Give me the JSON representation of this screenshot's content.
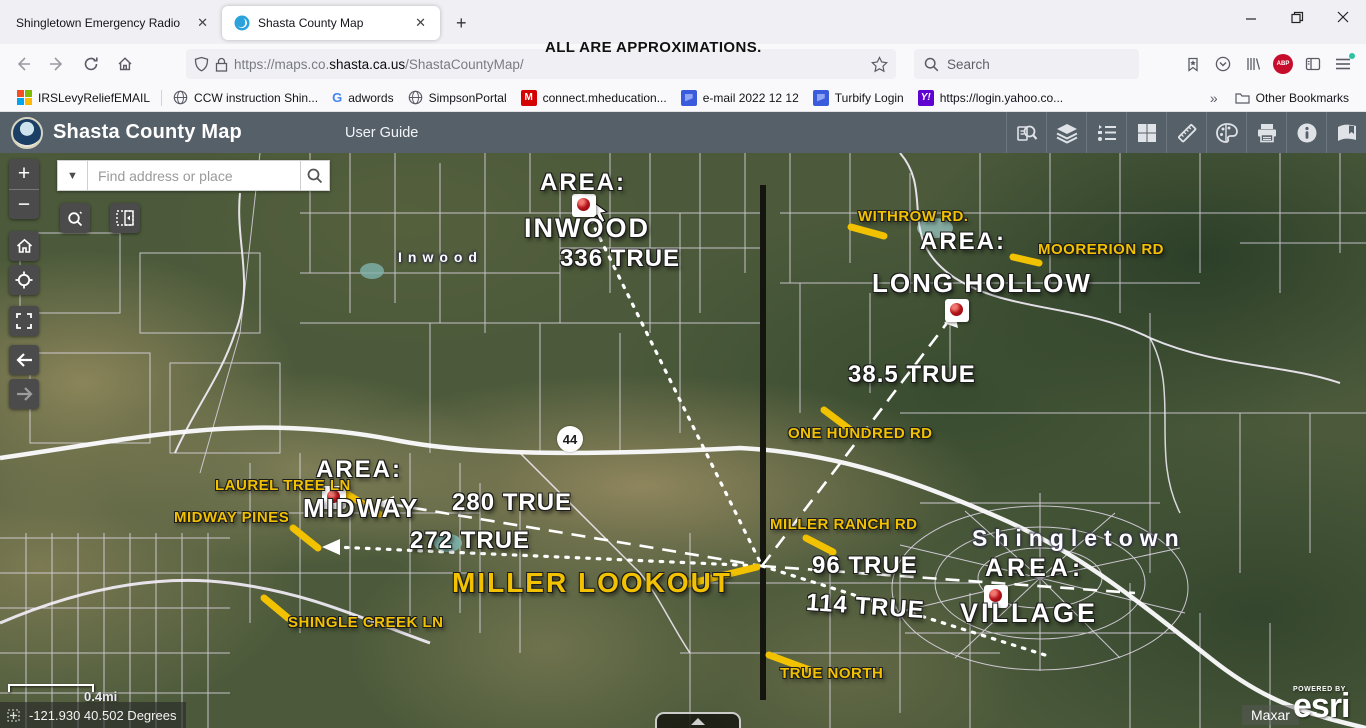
{
  "browser": {
    "tabs": [
      {
        "label": "Shingletown Emergency Radio"
      },
      {
        "label": "Shasta County Map"
      }
    ],
    "close_tab_glyph": "✕",
    "new_tab_glyph": "+",
    "url_prefix": "https://maps.co.",
    "url_domain": "shasta.ca.us",
    "url_path": "/ShastaCountyMap/",
    "search_placeholder": "Search",
    "bookmarks": [
      "IRSLevyReliefEMAIL",
      "CCW instruction Shin...",
      "adwords",
      "SimpsonPortal",
      "connect.mheducation...",
      "e-mail 2022 12 12",
      "Turbify Login",
      "https://login.yahoo.co..."
    ],
    "bookmarks_overflow_glyph": "»",
    "other_bookmarks_label": "Other Bookmarks",
    "adblock_badge": "ABP"
  },
  "overlay_note": "ALL ARE APPROXIMATIONS.",
  "app": {
    "title": "Shasta County Map",
    "user_guide_label": "User Guide",
    "toolbar_icons": [
      "query-search",
      "layers",
      "legend",
      "basemap-gallery",
      "measure",
      "draw",
      "print",
      "info",
      "bookmarks"
    ]
  },
  "map": {
    "find_placeholder": "Find address or place",
    "dropdown_glyph": "▼",
    "highway_shield": "44",
    "place_labels": {
      "inwood": "Inwood",
      "shingletown": "Shingletown"
    },
    "annotations": {
      "area_inwood_header": "AREA:",
      "inwood": "INWOOD",
      "bearing_336": "336 TRUE",
      "withrow_rd": "WITHROW RD.",
      "area_long_hollow_header": "AREA:",
      "moorerion_rd": "MOORERION RD",
      "long_hollow": "LONG HOLLOW",
      "bearing_385": "38.5 TRUE",
      "one_hundred_rd": "ONE HUNDRED RD",
      "area_midway_header": "AREA:",
      "laurel_tree_ln": "LAUREL TREE LN",
      "midway": "MIDWAY",
      "midway_pines": "MIDWAY PINES",
      "bearing_280": "280 TRUE",
      "bearing_272": "272 TRUE",
      "miller_lookout": "MILLER LOOKOUT",
      "shingle_creek_ln": "SHINGLE CREEK LN",
      "miller_ranch_rd": "MILLER RANCH RD",
      "bearing_96": "96 TRUE",
      "area_village_header": "AREA:",
      "village": "VILLAGE",
      "bearing_114": "114 TRUE",
      "true_north": "TRUE NORTH"
    },
    "scale_label": "0.4mi",
    "coordinates": "-121.930 40.502 Degrees",
    "attribution": {
      "maxar": "Maxar",
      "powered_by": "POWERED BY",
      "esri": "esri"
    },
    "colors": {
      "annotation_yellow": "#f2c200",
      "annotation_white": "#ffffff",
      "north_line": "#15150f"
    }
  }
}
